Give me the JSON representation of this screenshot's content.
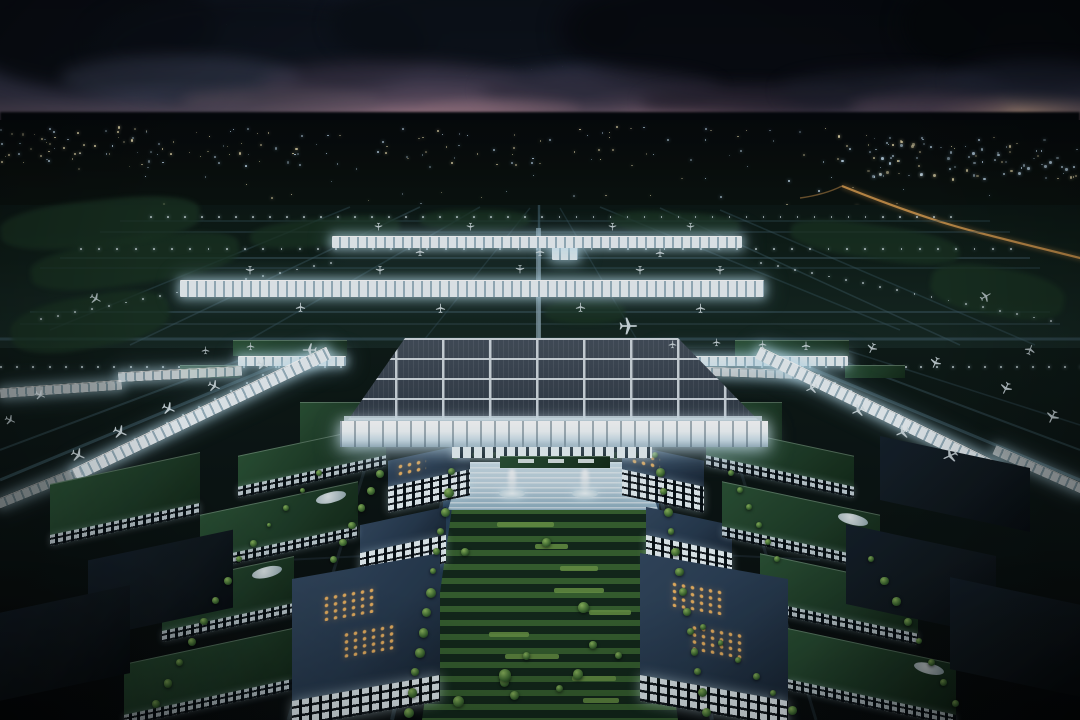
{
  "meta": {
    "title": "Night aerial rendering of a symmetrical airport complex at dusk",
    "type": "architectural-visualization",
    "time_of_day": "dusk"
  },
  "scene": {
    "sky": {
      "description": "Dusk sky with heavy dark clouds, scattered stars, and a pink-to-amber sunset glow along the horizon"
    },
    "horizon": {
      "description": "Distant city lights across the horizon, densest at the right, with an amber-lit winding road on the right side"
    },
    "airfield": {
      "description": "Dark teal apron and taxiway network with edge lights, two long illuminated linear concourses with parked aircraft, diagonal lit piers on both flanks",
      "concourse_count": 2
    },
    "terminal": {
      "description": "Central terminal with a gridded skylight roof and a glowing white facade, flanked by green-roofed lit galleries",
      "skylight_cols": 8,
      "skylight_rows": 4
    },
    "campus": {
      "description": "Symmetrical landside campus: green-roofed blocks with lit white facades, glass roofs with amber window grids, tree-lined boulevards, a stepped light plaza with two fountains and a long central garden axis",
      "fountain_count": 2
    },
    "aircraft_visible": "approximately 40 white aircraft parked and taxiing"
  },
  "palette": {
    "sky_top": "#161c2b",
    "sky_mid": "#2a3147",
    "sunset_pink": "#d99aa8",
    "sunset_amber": "#d8a87e",
    "cloud_dark": "#0a0d14",
    "horizon_silhouette": "#04060a",
    "far_ground": "#080d0b",
    "city_light_warm": "#e9dcae",
    "city_light_cool": "#c3dcee",
    "road_amber": "#d79a4e",
    "airfield_dark": "#0c1713",
    "airfield_light": "#172823",
    "taxiway_line": "#3d5a64",
    "infield_green": "#1b3422",
    "concourse_white": "#f0f7fa",
    "concourse_shadow": "#9db6c2",
    "terminal_roof": "#3a4450",
    "terminal_grid": "#e6eef3",
    "facade_glow": "#f6fbfd",
    "plaza_light": "#bcd2de",
    "water_channel": "#1e3347",
    "garden_dark": "#13291a",
    "hedge_green": "#38622f",
    "hedge_bright": "#6f9a46",
    "tree_green": "#3c682e",
    "tree_highlight": "#8fba5e",
    "roof_green": "#1f3d27",
    "roof_glass": "#283b50",
    "window_amber": "#f3b763",
    "window_white": "#ecf6fa",
    "building_dark": "#10181d",
    "aircraft_white": "#dde8ec"
  }
}
